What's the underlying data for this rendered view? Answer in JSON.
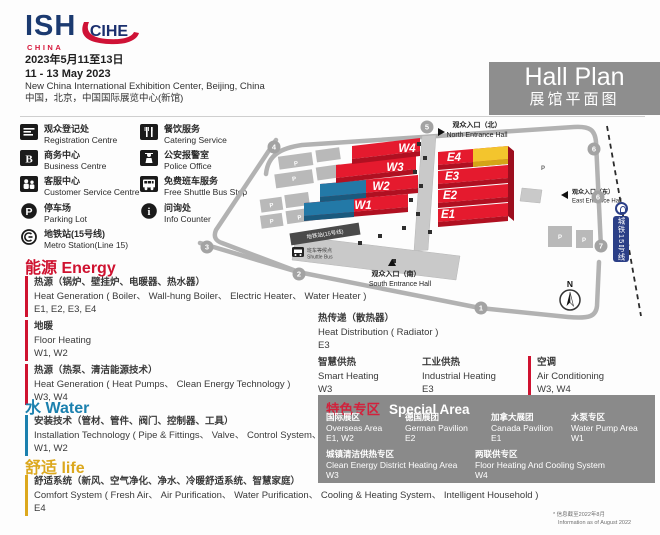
{
  "header": {
    "logo": {
      "ish": "ISH",
      "ish_sub": "CHINA",
      "cihe": "CIHE"
    },
    "date_cn": "2023年5月11至13日",
    "date_en": "11 - 13 May 2023",
    "venue_en": "New China International Exhibition Center, Beijing, China",
    "venue_cn": "中国，北京，中国国际展览中心(新馆)",
    "hall_plan_en": "Hall Plan",
    "hall_plan_cn": "展馆平面图"
  },
  "legend": {
    "col1": [
      {
        "cn": "观众登记处",
        "en": "Registration Centre"
      },
      {
        "cn": "商务中心",
        "en": "Business Centre"
      },
      {
        "cn": "客服中心",
        "en": "Customer Service Centre"
      },
      {
        "cn": "停车场",
        "en": "Parking Lot"
      },
      {
        "cn": "地铁站(15号线)",
        "en": "Metro Station(Line 15)"
      }
    ],
    "col2": [
      {
        "cn": "餐饮服务",
        "en": "Catering Service"
      },
      {
        "cn": "公安报警室",
        "en": "Police Office"
      },
      {
        "cn": "免费班车服务",
        "en": "Free Shuttle Bus Stop"
      },
      {
        "cn": "问询处",
        "en": "Info Counter"
      }
    ]
  },
  "map": {
    "halls": [
      "W4",
      "W3",
      "W2",
      "W1",
      "E4",
      "E3",
      "E2",
      "E1"
    ],
    "gates": [
      "4",
      "5",
      "6",
      "6",
      "7",
      "3",
      "2",
      "1"
    ],
    "entrances": {
      "north": {
        "cn": "观众入口（北）",
        "en": "North Entrance Hall"
      },
      "east": {
        "cn": "观众入口（东）",
        "en": "East Entrance Hall"
      },
      "south": {
        "cn": "观众入口（南）",
        "en": "South Entrance Hall"
      }
    },
    "metro_line_banner": "城铁15号线",
    "metro_station": "地铁站(15号线)",
    "shuttle": {
      "cn": "班车等候点",
      "en": "Shuttle Bus"
    },
    "compass": "N",
    "parking_letter": "P"
  },
  "sections": {
    "energy": {
      "title_cn": "能源",
      "title_en": "Energy",
      "items": [
        {
          "cn": "热源（锅炉、壁挂炉、电暖器、热水器）",
          "en": "Heat Generation ( Boiler、 Wall-hung Boiler、 Electric Heater、 Water Heater )",
          "halls": "E1, E2, E3, E4"
        },
        {
          "cn": "地暖",
          "en": "Floor Heating",
          "halls": "W1, W2"
        },
        {
          "cn": "热源（热泵、清洁能源技术）",
          "en": "Heat Generation ( Heat Pumps、 Clean Energy Technology )",
          "halls": "W3, W4"
        },
        {
          "cn": "热传递（散热器）",
          "en": "Heat Distribution ( Radiator )",
          "halls": "E3"
        },
        {
          "cn": "智慧供热",
          "en": "Smart Heating",
          "halls": "W3"
        },
        {
          "cn": "工业供热",
          "en": "Industrial Heating",
          "halls": "E3"
        },
        {
          "cn": "空调",
          "en": "Air Conditioning",
          "halls": "W3, W4"
        }
      ]
    },
    "water": {
      "title_cn": "水",
      "title_en": "Water",
      "items": [
        {
          "cn": "安装技术（管材、管件、阀门、控制器、工具）",
          "en": "Installation Technology ( Pipe & Fittings、 Valve、 Control System、 Tools )",
          "halls": "W1, W2"
        }
      ]
    },
    "life": {
      "title_cn": "舒适",
      "title_en": "life",
      "items": [
        {
          "cn": "舒适系统（新风、空气净化、净水、冷暖舒适系统、智慧家庭）",
          "en": "Comfort System ( Fresh Air、 Air Purification、 Water Purification、 Cooling & Heating System、 Intelligent Household )",
          "halls": "E4"
        }
      ]
    }
  },
  "special_area": {
    "title_cn": "特色专区",
    "title_en": "Special Area",
    "items": [
      {
        "cn": "国际展区",
        "en": "Overseas Area",
        "halls": "E1, W2"
      },
      {
        "cn": "德国展团",
        "en": "German Pavilion",
        "halls": "E2"
      },
      {
        "cn": "加拿大展团",
        "en": "Canada Pavilion",
        "halls": "E1"
      },
      {
        "cn": "水泵专区",
        "en": "Water Pump Area",
        "halls": "W1"
      },
      {
        "cn": "城镇清洁供热专区",
        "en": "Clean Energy District Heating Area",
        "halls": "W3"
      },
      {
        "cn": "两联供专区",
        "en": "Floor Heating And Cooling System",
        "halls": "W4"
      }
    ]
  },
  "footnote": {
    "cn": "* 信息截至2022年8月",
    "en": "Information as of August 2022"
  },
  "colors": {
    "hall_red": "#e51a2e",
    "hall_blue": "#2379a7",
    "hall_yellow": "#f3c52d",
    "energy_red": "#cf1230",
    "water_blue": "#1b80ae",
    "life_gold": "#dca81e",
    "box_gray": "#8a8a8a",
    "brand_navy": "#1b3a70",
    "brand_red": "#d6173a",
    "metro_navy": "#2b3f87"
  }
}
